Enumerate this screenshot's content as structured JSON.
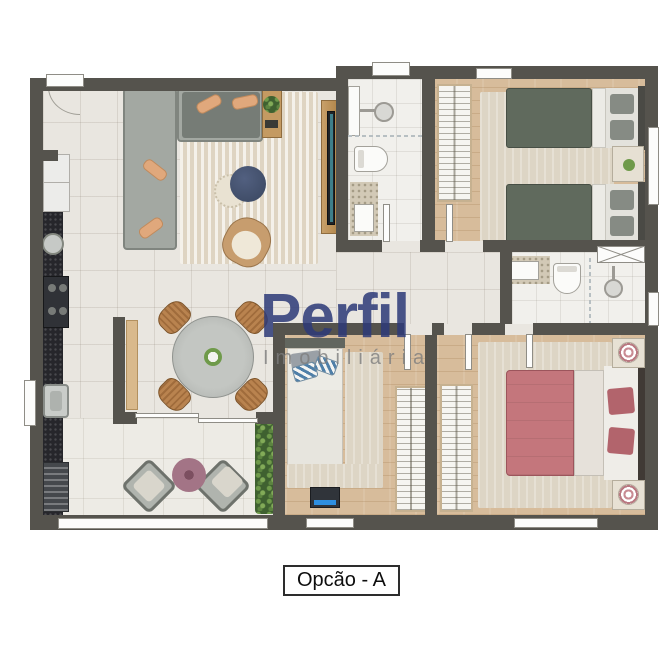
{
  "watermark": {
    "brand": "Perfil",
    "tagline": "Imobiliária",
    "brand_color": "#2d3a78",
    "tagline_color": "#7d7d7d"
  },
  "caption": {
    "label": "Opcão - A"
  },
  "palette": {
    "background": "#ffffff",
    "wall": "#55534d",
    "tile_floor": "#e9e6e0",
    "wood_floor": "#d7bc9b",
    "bath_floor": "#f1f0ec",
    "granite_dark": "#26262b",
    "granite_beige": "#d2c9b6",
    "sofa_gray": "#a3a8a2",
    "duvet_green": "#606a5d",
    "duvet_pink": "#c4767c",
    "pouf_navy": "#46536f",
    "pouf_mauve": "#a37486",
    "accent_blue": "#2f8fe0",
    "plant_green": "#4e7a3d",
    "cushion_tan": "#e0a87c"
  },
  "rooms": [
    {
      "name": "kitchen"
    },
    {
      "name": "living-dining"
    },
    {
      "name": "balcony"
    },
    {
      "name": "corridor"
    },
    {
      "name": "bathroom-1"
    },
    {
      "name": "bedroom-1-twin"
    },
    {
      "name": "bathroom-2"
    },
    {
      "name": "bedroom-2-master"
    },
    {
      "name": "bedroom-3-single"
    }
  ]
}
